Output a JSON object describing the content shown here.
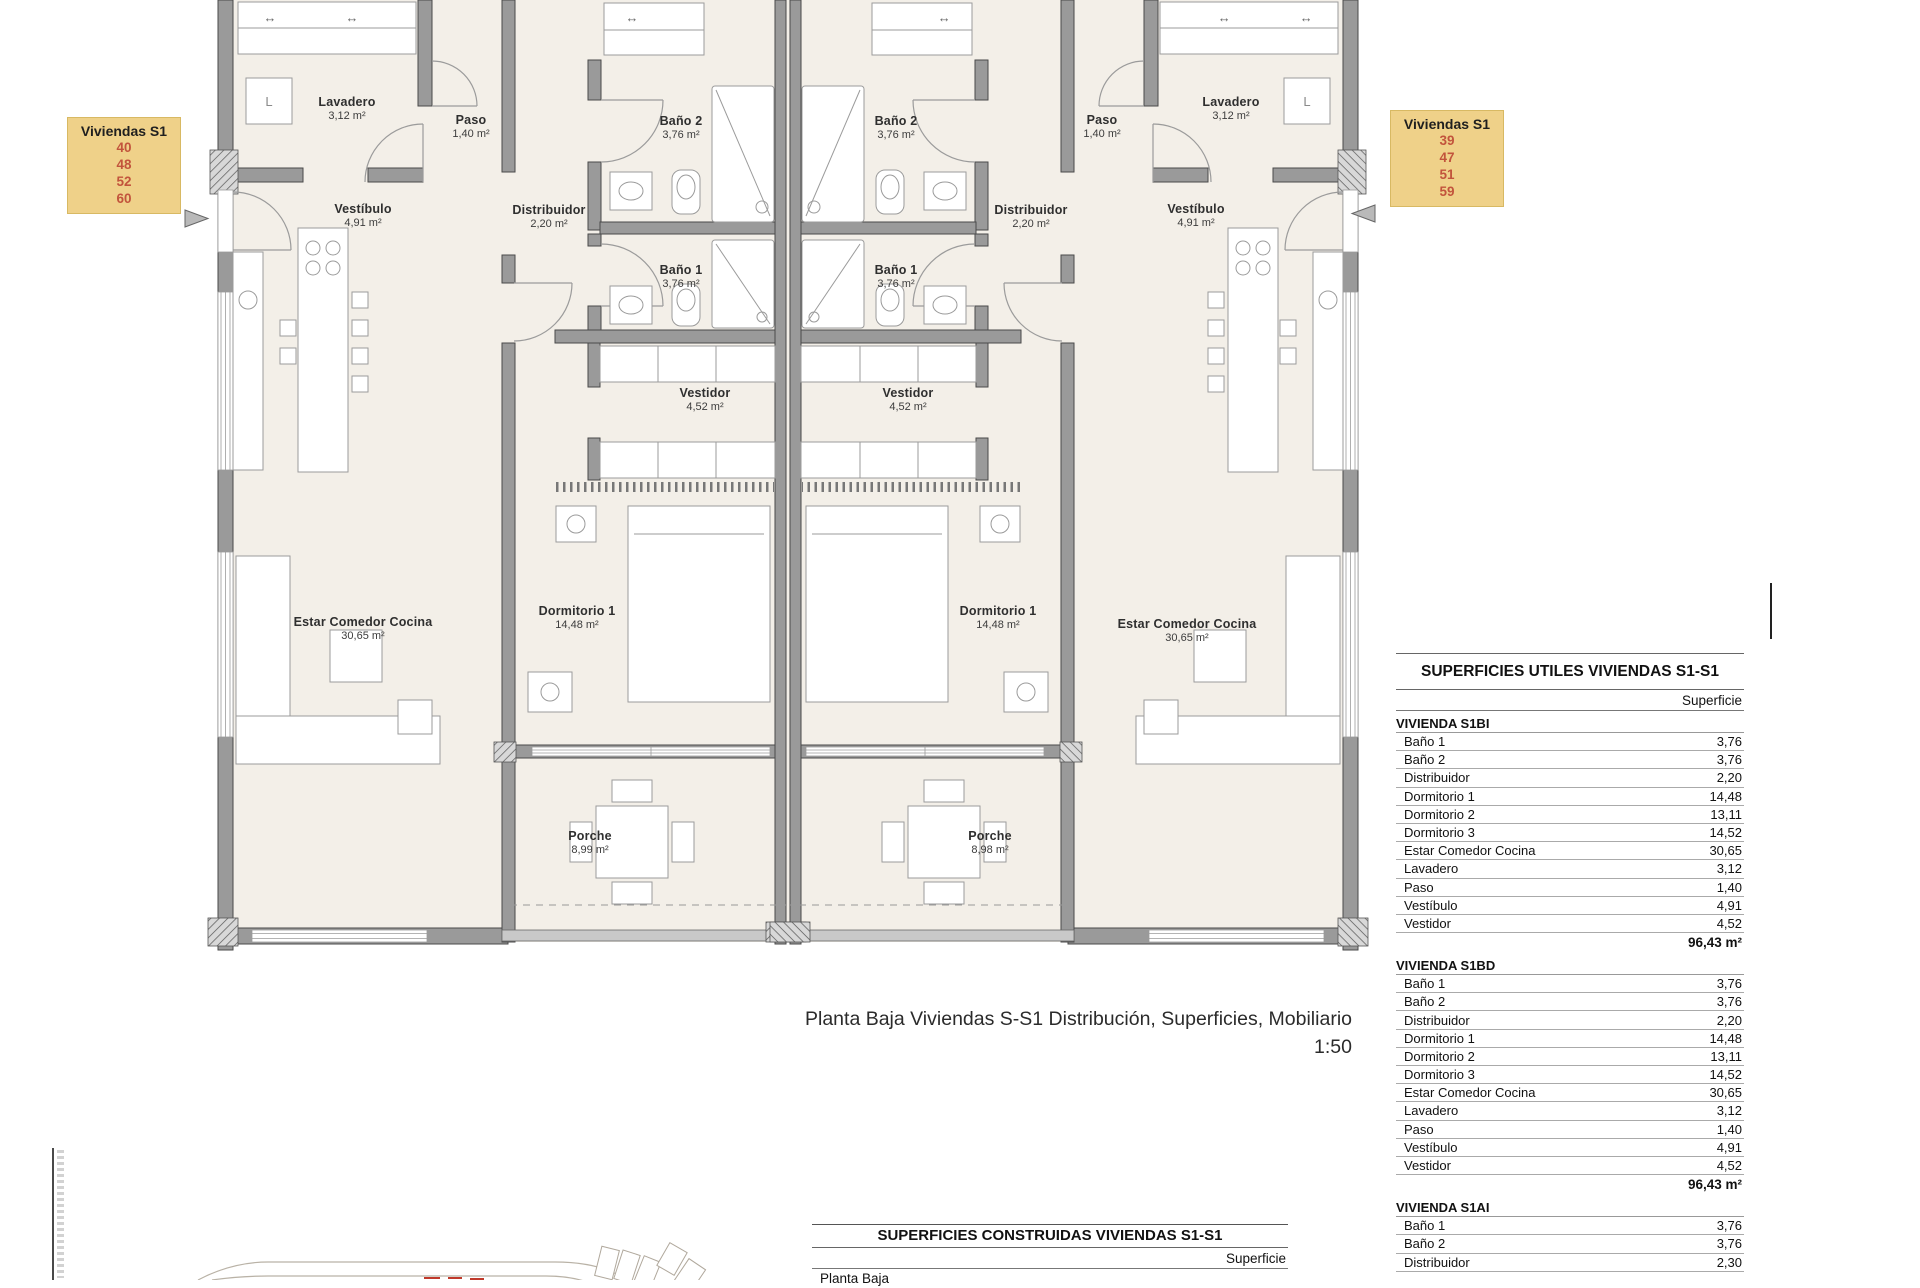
{
  "plan": {
    "left_unit_tag": {
      "title": "Viviendas S1",
      "numbers": [
        "40",
        "48",
        "52",
        "60"
      ]
    },
    "right_unit_tag": {
      "title": "Viviendas S1",
      "numbers": [
        "39",
        "47",
        "51",
        "59"
      ]
    },
    "appliance_letter_left": "L",
    "appliance_letter_right": "L",
    "rooms": [
      {
        "name": "Lavadero",
        "area": "3,12 m²"
      },
      {
        "name": "Paso",
        "area": "1,40 m²"
      },
      {
        "name": "Baño 2",
        "area": "3,76 m²"
      },
      {
        "name": "Vestíbulo",
        "area": "4,91 m²"
      },
      {
        "name": "Distribuidor",
        "area": "2,20 m²"
      },
      {
        "name": "Baño 1",
        "area": "3,76 m²"
      },
      {
        "name": "Vestidor",
        "area": "4,52 m²"
      },
      {
        "name": "Dormitorio 1",
        "area": "14,48 m²"
      },
      {
        "name": "Estar Comedor Cocina",
        "area": "30,65 m²"
      },
      {
        "name": "Porche",
        "area": "8,99 m²"
      },
      {
        "name": "Baño 2",
        "area": "3,76 m²"
      },
      {
        "name": "Paso",
        "area": "1,40 m²"
      },
      {
        "name": "Lavadero",
        "area": "3,12 m²"
      },
      {
        "name": "Distribuidor",
        "area": "2,20 m²"
      },
      {
        "name": "Vestíbulo",
        "area": "4,91 m²"
      },
      {
        "name": "Baño 1",
        "area": "3,76 m²"
      },
      {
        "name": "Vestidor",
        "area": "4,52 m²"
      },
      {
        "name": "Dormitorio 1",
        "area": "14,48 m²"
      },
      {
        "name": "Estar Comedor Cocina",
        "area": "30,65 m²"
      },
      {
        "name": "Porche",
        "area": "8,98 m²"
      }
    ]
  },
  "title_block": {
    "title": "Planta Baja Viviendas S-S1 Distribución, Superficies, Mobiliario",
    "scale": "1:50"
  },
  "tables": {
    "utiles": {
      "heading": "SUPERFICIES UTILES VIVIENDAS S1-S1",
      "col_header": "Superficie",
      "sections": [
        {
          "name": "VIVIENDA S1BI",
          "rows": [
            {
              "label": "Baño 1",
              "value": "3,76"
            },
            {
              "label": "Baño 2",
              "value": "3,76"
            },
            {
              "label": "Distribuidor",
              "value": "2,20"
            },
            {
              "label": "Dormitorio 1",
              "value": "14,48"
            },
            {
              "label": "Dormitorio 2",
              "value": "13,11"
            },
            {
              "label": "Dormitorio 3",
              "value": "14,52"
            },
            {
              "label": "Estar Comedor Cocina",
              "value": "30,65"
            },
            {
              "label": "Lavadero",
              "value": "3,12"
            },
            {
              "label": "Paso",
              "value": "1,40"
            },
            {
              "label": "Vestíbulo",
              "value": "4,91"
            },
            {
              "label": "Vestidor",
              "value": "4,52"
            }
          ],
          "total": "96,43 m²"
        },
        {
          "name": "VIVIENDA S1BD",
          "rows": [
            {
              "label": "Baño 1",
              "value": "3,76"
            },
            {
              "label": "Baño 2",
              "value": "3,76"
            },
            {
              "label": "Distribuidor",
              "value": "2,20"
            },
            {
              "label": "Dormitorio 1",
              "value": "14,48"
            },
            {
              "label": "Dormitorio 2",
              "value": "13,11"
            },
            {
              "label": "Dormitorio 3",
              "value": "14,52"
            },
            {
              "label": "Estar Comedor Cocina",
              "value": "30,65"
            },
            {
              "label": "Lavadero",
              "value": "3,12"
            },
            {
              "label": "Paso",
              "value": "1,40"
            },
            {
              "label": "Vestíbulo",
              "value": "4,91"
            },
            {
              "label": "Vestidor",
              "value": "4,52"
            }
          ],
          "total": "96,43 m²"
        },
        {
          "name": "VIVIENDA S1AI",
          "rows": [
            {
              "label": "Baño 1",
              "value": "3,76"
            },
            {
              "label": "Baño 2",
              "value": "3,76"
            },
            {
              "label": "Distribuidor",
              "value": "2,30"
            }
          ],
          "total": ""
        }
      ]
    },
    "construidas": {
      "heading": "SUPERFICIES CONSTRUIDAS VIVIENDAS S1-S1",
      "col_header": "Superficie",
      "rows": [
        {
          "label": "Planta Baja",
          "value": ""
        }
      ]
    }
  },
  "colors": {
    "floor": "#f3efe8",
    "wall": "#9a9a9a",
    "tag_background": "#efd189",
    "tag_numbers": "#c2543c",
    "red_marks": "#c0392b"
  }
}
